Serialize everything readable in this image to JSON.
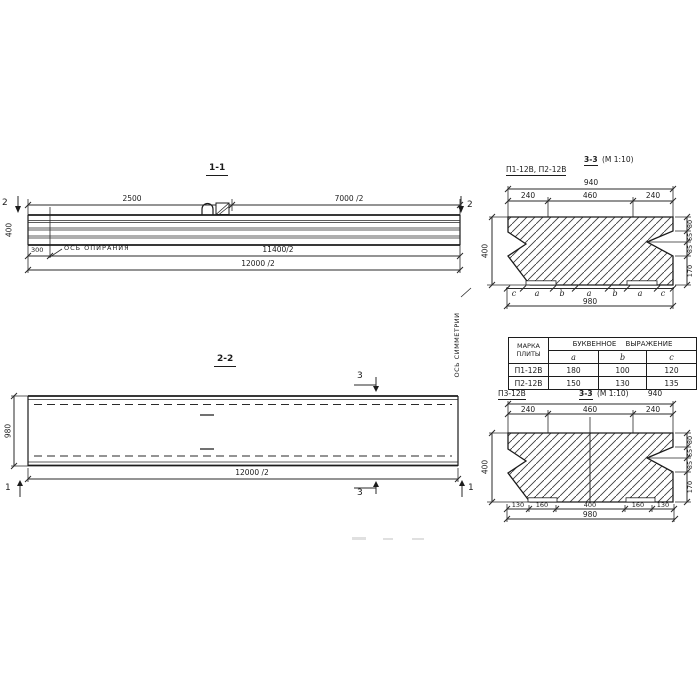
{
  "s11": {
    "title": "1-1",
    "cut2": "2",
    "d2500": "2500",
    "d7000": "7000 /2",
    "d400": "400",
    "d300": "300",
    "axis_label": "ОСЬ ОПИРАНИЯ",
    "d11400": "11400/2",
    "d12000": "12000 /2"
  },
  "sym_axis_label": "ОСЬ СИММЕТРИИ",
  "s22": {
    "title": "2-2",
    "cut3": "3",
    "cut1": "1",
    "d980": "980",
    "d12000": "12000 /2"
  },
  "sec_top": {
    "label": "П1-12В, П2-12В",
    "title_cut": "3-3",
    "title_scale": "(М 1:10)",
    "d940": "940",
    "d240": "240",
    "d460": "460",
    "d400": "400",
    "d80": "80",
    "d65": "65",
    "d85": "85",
    "d170": "170",
    "d980": "980",
    "letters": [
      "c",
      "a",
      "b",
      "a",
      "b",
      "a",
      "c"
    ]
  },
  "table": {
    "col1_line1": "МАРКА",
    "col1_line2": "ПЛИТЫ",
    "header": "БУКВЕННОЕ ВЫРАЖЕНИЕ",
    "cols": [
      "a",
      "b",
      "c"
    ],
    "rows": [
      {
        "mark": "П1-12В",
        "a": "180",
        "b": "100",
        "c": "120"
      },
      {
        "mark": "П2-12В",
        "a": "150",
        "b": "130",
        "c": "135"
      }
    ]
  },
  "sec_bot": {
    "label": "П3-12В",
    "title_cut": "3-3",
    "title_scale": "(М 1:10)",
    "d940": "940",
    "d240": "240",
    "d460": "460",
    "d400": "400",
    "d80": "80",
    "d65": "65",
    "d85": "85",
    "d170": "170",
    "d130": "130",
    "d160": "160",
    "d400b": "400",
    "d980": "980"
  }
}
